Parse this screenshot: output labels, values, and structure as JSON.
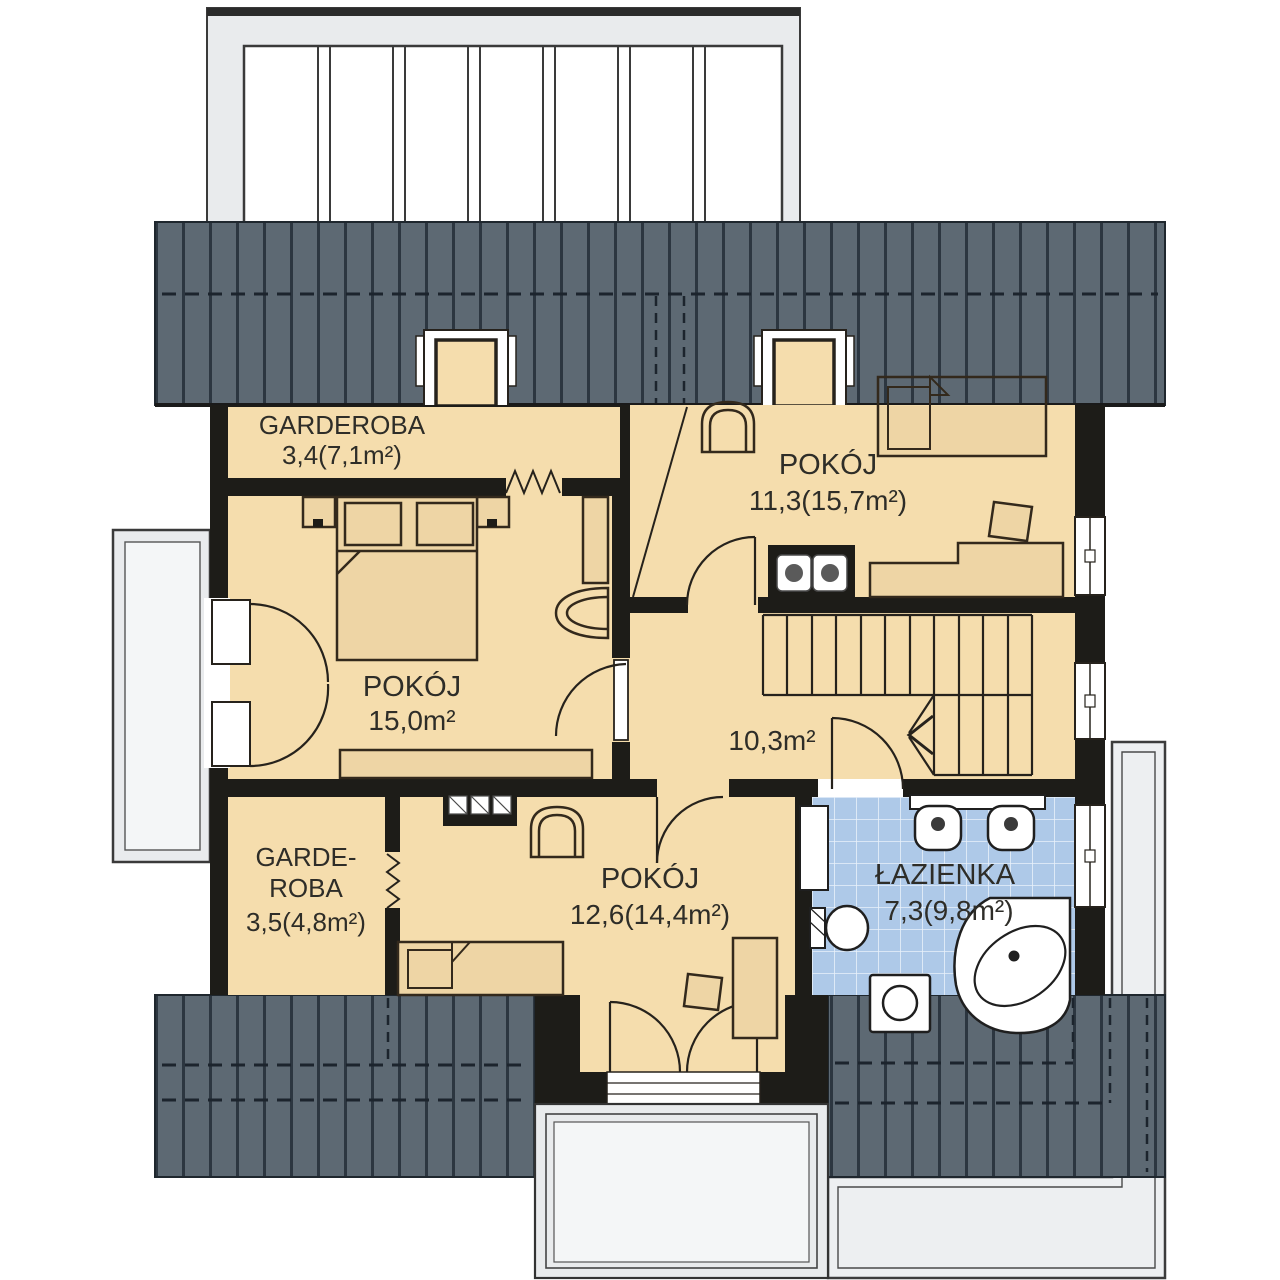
{
  "plan": {
    "rooms": [
      {
        "key": "garderoba_top",
        "name": "GARDEROBA",
        "area": "3,4(7,1m²)"
      },
      {
        "key": "pokoj_left",
        "name": "POKÓJ",
        "area": "15,0m²"
      },
      {
        "key": "pokoj_top_right",
        "name": "POKÓJ",
        "area": "11,3(15,7m²)"
      },
      {
        "key": "hall",
        "name": "",
        "area": "10,3m²"
      },
      {
        "key": "garderoba_bottom",
        "name": "GARDE-",
        "name2": "ROBA",
        "area": "3,5(4,8m²)"
      },
      {
        "key": "pokoj_bottom",
        "name": "POKÓJ",
        "area": "12,6(14,4m²)"
      },
      {
        "key": "lazienka",
        "name": "ŁAZIENKA",
        "area": "7,3(9,8m²)"
      }
    ]
  },
  "palette": {
    "wall": "#1d1c18",
    "floor": "#f5ddad",
    "furniture": "#eed5a5",
    "roof": "#5d6973",
    "roof_stripe": "#2c3640",
    "roof_dash": "#1c242d",
    "tile": "#aec9e8",
    "tile_grid": "#e9f1fa",
    "terrace": "#edeff1",
    "balcony_frame": "#e9ebed",
    "balcony_inner": "#f4f6f7",
    "white": "#ffffff",
    "line": "#26221c",
    "text": "#2e2d28"
  }
}
